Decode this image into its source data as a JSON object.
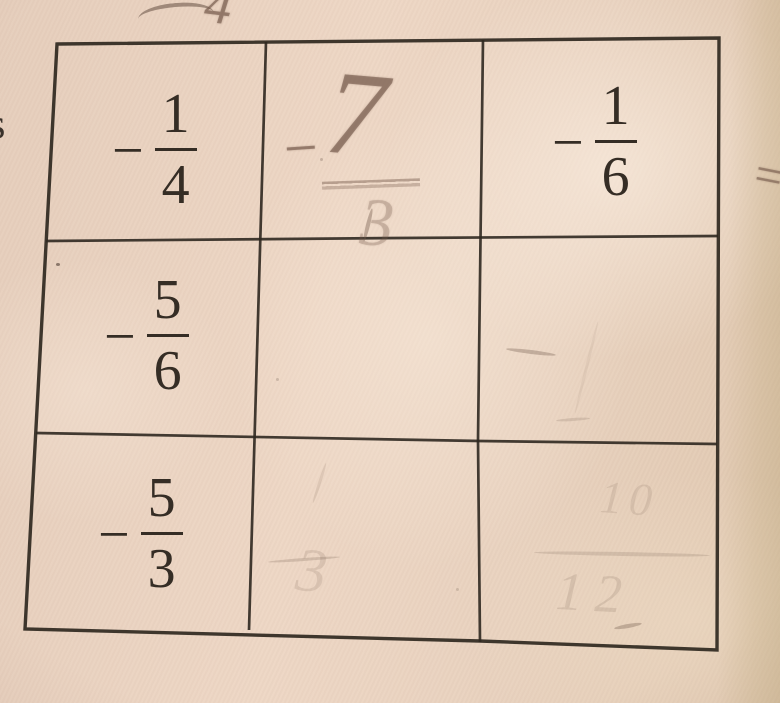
{
  "table": {
    "rows": [
      [
        {
          "sign": "−",
          "num": "1",
          "den": "4",
          "style": "printed"
        },
        {
          "sign": "−",
          "num": "7",
          "den": "3",
          "style": "pencil"
        },
        {
          "sign": "−",
          "num": "1",
          "den": "6",
          "style": "printed"
        }
      ],
      [
        {
          "sign": "−",
          "num": "5",
          "den": "6",
          "style": "printed"
        },
        {
          "style": "empty"
        },
        {
          "style": "faint-smudges"
        }
      ],
      [
        {
          "sign": "−",
          "num": "5",
          "den": "3",
          "style": "printed"
        },
        {
          "style": "erased",
          "faint": "3"
        },
        {
          "style": "erased",
          "faint_num": "10",
          "faint_den": "12"
        }
      ]
    ]
  },
  "stray_marks": {
    "top_pencil_digit": "4",
    "left_edge_letter": "s",
    "right_pencil_equals": "="
  },
  "colors": {
    "paper": "#ecd5c3",
    "paper_edge": "#dcc6a4",
    "ink": "#352d25",
    "pencil": "#74594a"
  }
}
